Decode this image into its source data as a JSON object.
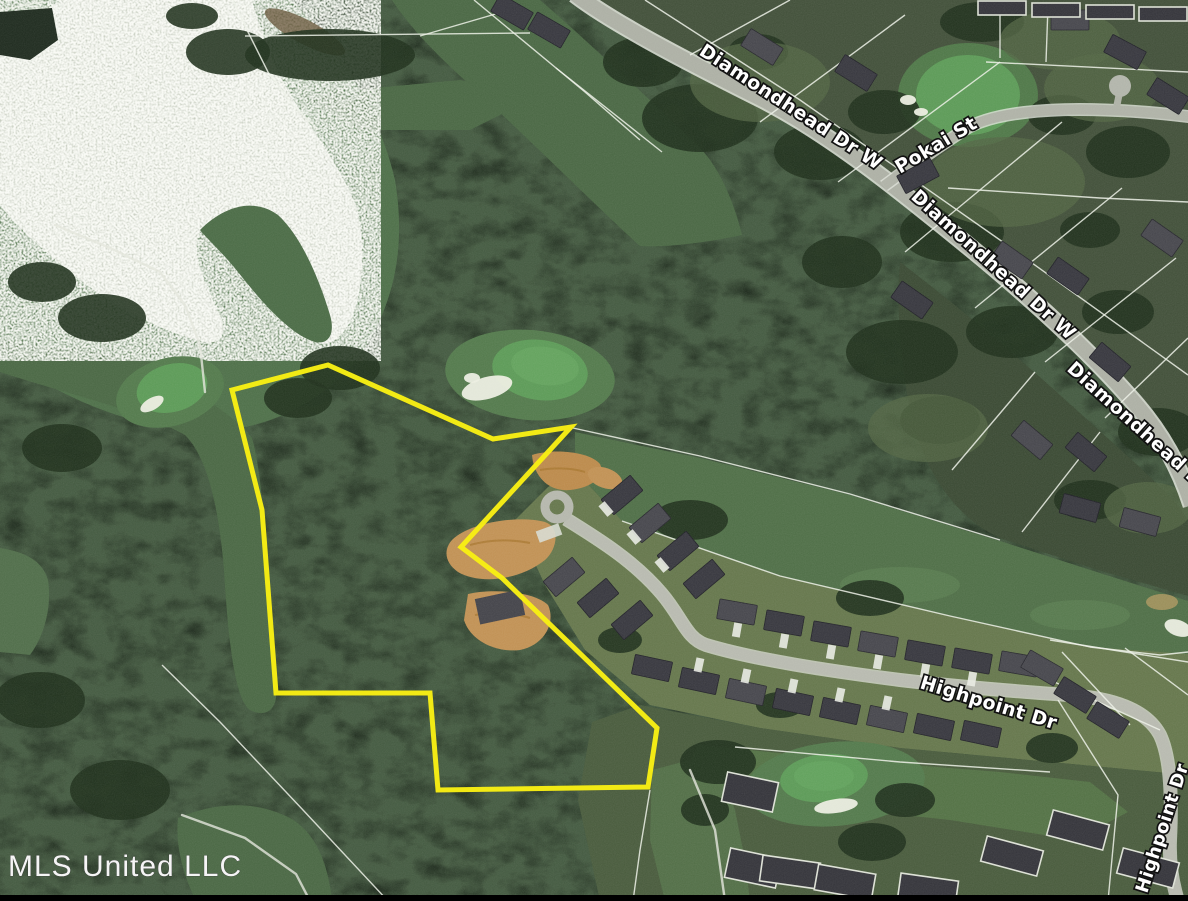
{
  "map": {
    "watermark": "MLS United LLC",
    "labels": [
      {
        "id": "diamondhead-dr-w-upper",
        "text": "Diamondhead Dr W"
      },
      {
        "id": "diamondhead-dr-w-lower",
        "text": "Diamondhead Dr W"
      },
      {
        "id": "diamondhead-dr-right",
        "text": "Diamondhead Dr"
      },
      {
        "id": "pokai-st",
        "text": "Pokai St"
      },
      {
        "id": "highpoint-dr-main",
        "text": "Highpoint Dr"
      },
      {
        "id": "highpoint-dr-right",
        "text": "Highpoint Dr"
      }
    ],
    "boundary_points": [
      [
        232,
        390
      ],
      [
        328,
        365
      ],
      [
        493,
        439
      ],
      [
        571,
        427
      ],
      [
        461,
        547
      ],
      [
        502,
        578
      ],
      [
        657,
        728
      ],
      [
        648,
        787
      ],
      [
        438,
        790
      ],
      [
        430,
        693
      ],
      [
        276,
        693
      ],
      [
        262,
        510
      ]
    ],
    "colors": {
      "boundary_yellow": "#f8ee14",
      "road_gray": "#b0b3a8",
      "forest_green": "#1f2b1e",
      "fairway_green": "#52714a",
      "putting_green": "#5f9c5a",
      "lake_gray": "#ccd1c5",
      "dirt_tan": "#c29357",
      "label_text": "#ffffff",
      "label_outline": "#111111",
      "watermark_text": "#f5f5f5"
    }
  }
}
